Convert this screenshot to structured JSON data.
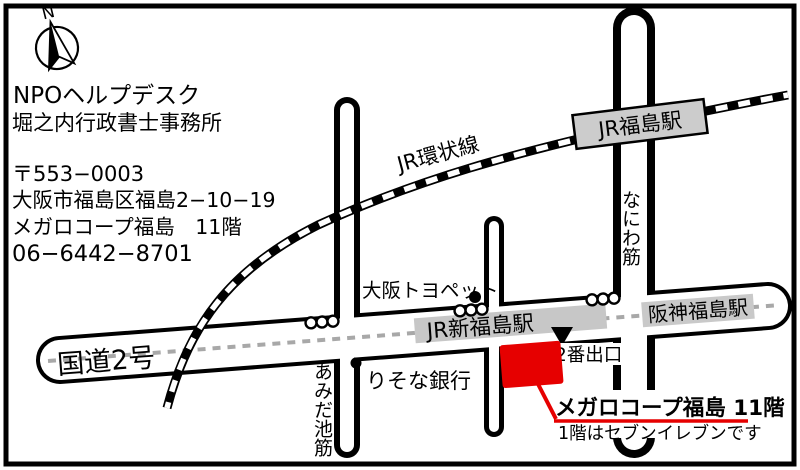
{
  "info": {
    "org_line1": "NPOヘルプデスク",
    "org_line2": "堀之内行政書士事務所",
    "postal": "〒553−0003",
    "address": "大阪市福島区福島2−10−19",
    "building": "メガロコープ福島　11階",
    "phone": "06−6442−8701"
  },
  "compass": {
    "north_label": "N"
  },
  "map": {
    "railway": {
      "line_label": "JR環状線",
      "station_label": "JR福島駅"
    },
    "roads": {
      "route2": "国道2号",
      "amidaike": "あみだ池筋",
      "naniwa": "なにわ筋"
    },
    "stations": {
      "shinfukushima": "JR新福島駅",
      "hanshin": "阪神福島駅"
    },
    "pois": {
      "toyopet": "大阪トヨペット",
      "resona": "りそな銀行"
    },
    "exit_label": "2番出口",
    "destination": {
      "title": "メガロコープ福島 11階",
      "note": "1階はセブンイレブンです"
    },
    "colors": {
      "destination_red": "#e60000",
      "station_gray": "#c7c7c7",
      "centerline_gray": "#a8a8a8"
    }
  }
}
